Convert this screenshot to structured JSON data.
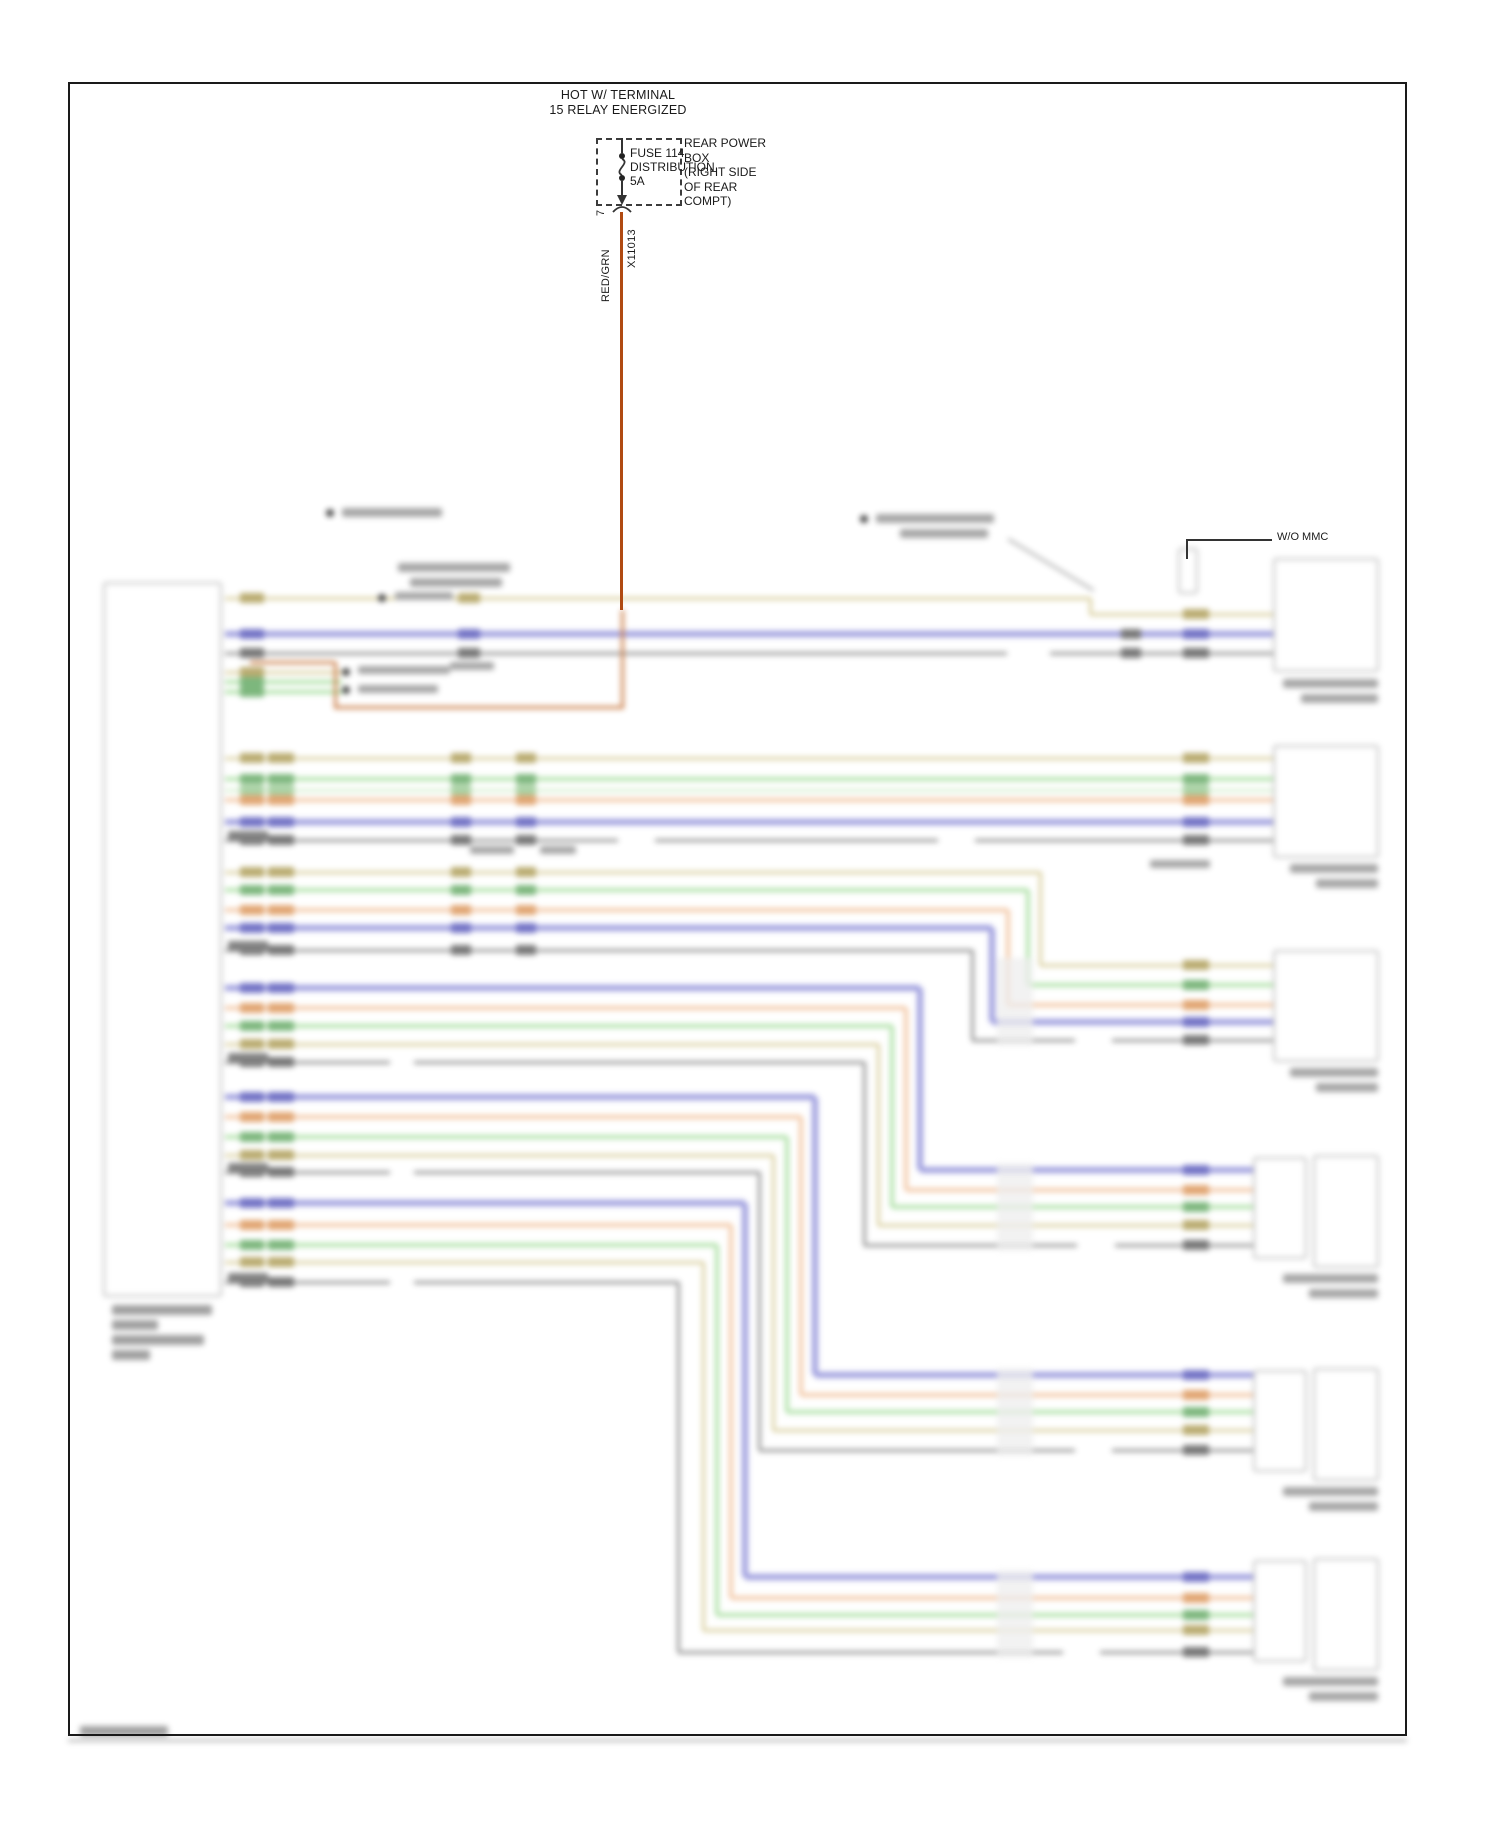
{
  "power_circuit": {
    "hot_label": [
      "HOT W/ TERMINAL",
      "15 RELAY ENERGIZED"
    ],
    "fuse": {
      "name": "FUSE 114",
      "type": "DISTRIBUTION",
      "rating": "5A"
    },
    "location_label": [
      "REAR POWER",
      "BOX",
      "(RIGHT SIDE",
      "OF REAR",
      "COMPT)"
    ],
    "pin": "7",
    "connector": "X11013",
    "wire_label": "RED/GRN"
  },
  "annotations": {
    "wo_mmc": "W/O MMC"
  },
  "colors": {
    "red_grn_wire": "#b04a12",
    "red_grn_faded": "#c87840",
    "tan": "#d6cb96",
    "green": "#aadfa2",
    "pale_green": "#d2eecb",
    "orange": "#f2c4a0",
    "blue": "#9898dc",
    "gray": "#8c8c8c",
    "box_border": "#bcbcbc",
    "outline": "#1a1a1a"
  }
}
